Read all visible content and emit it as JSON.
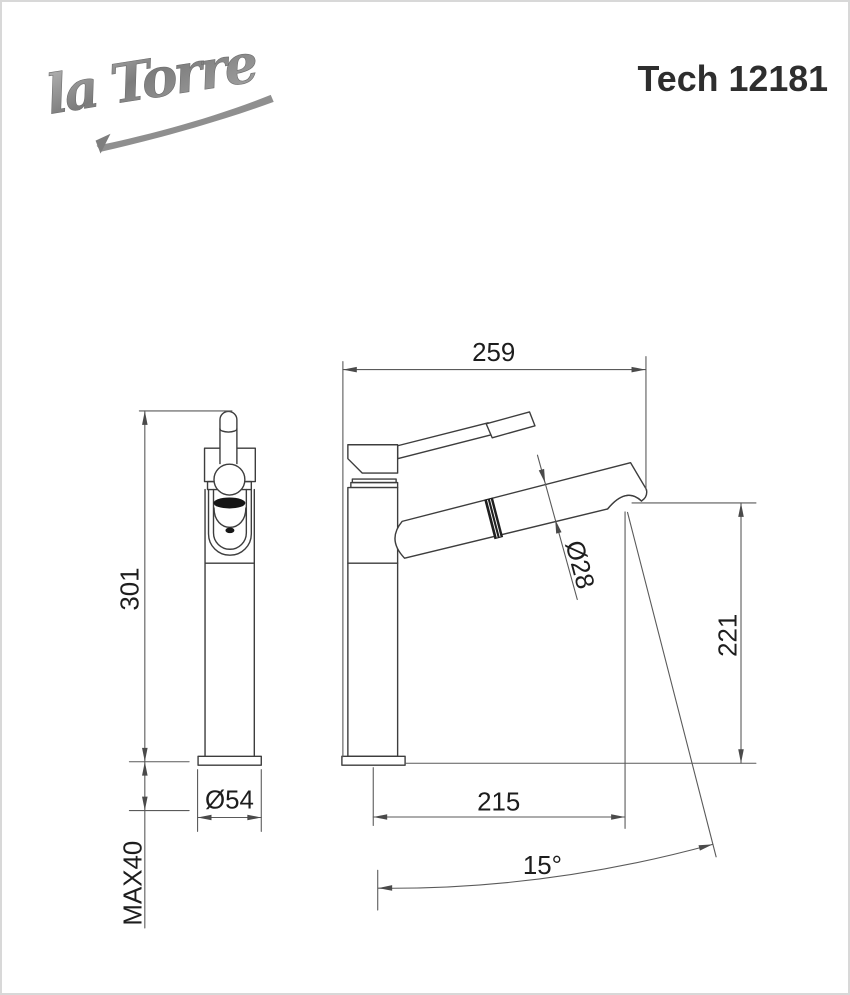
{
  "brand": {
    "logo_text": "la Torre"
  },
  "header": {
    "model_code": "Tech 12181"
  },
  "drawing": {
    "front_view": {
      "height_mm": "301",
      "base_diameter": "Ø54",
      "max_mounting_thickness": "MAX40"
    },
    "side_view": {
      "spout_reach_mm": "259",
      "spout_diameter": "Ø28",
      "spout_height_mm": "221",
      "spout_projection_mm": "215",
      "spout_angle": "15°"
    }
  },
  "colors": {
    "background": "#ffffff",
    "page_border": "#d8d8d8",
    "part_line": "#3d3d3d",
    "dimension_line": "#5a5a5a",
    "dimension_text": "#1d1d1d",
    "model_text": "#2e2e2e",
    "logo_gray": "#8f8f8f"
  }
}
